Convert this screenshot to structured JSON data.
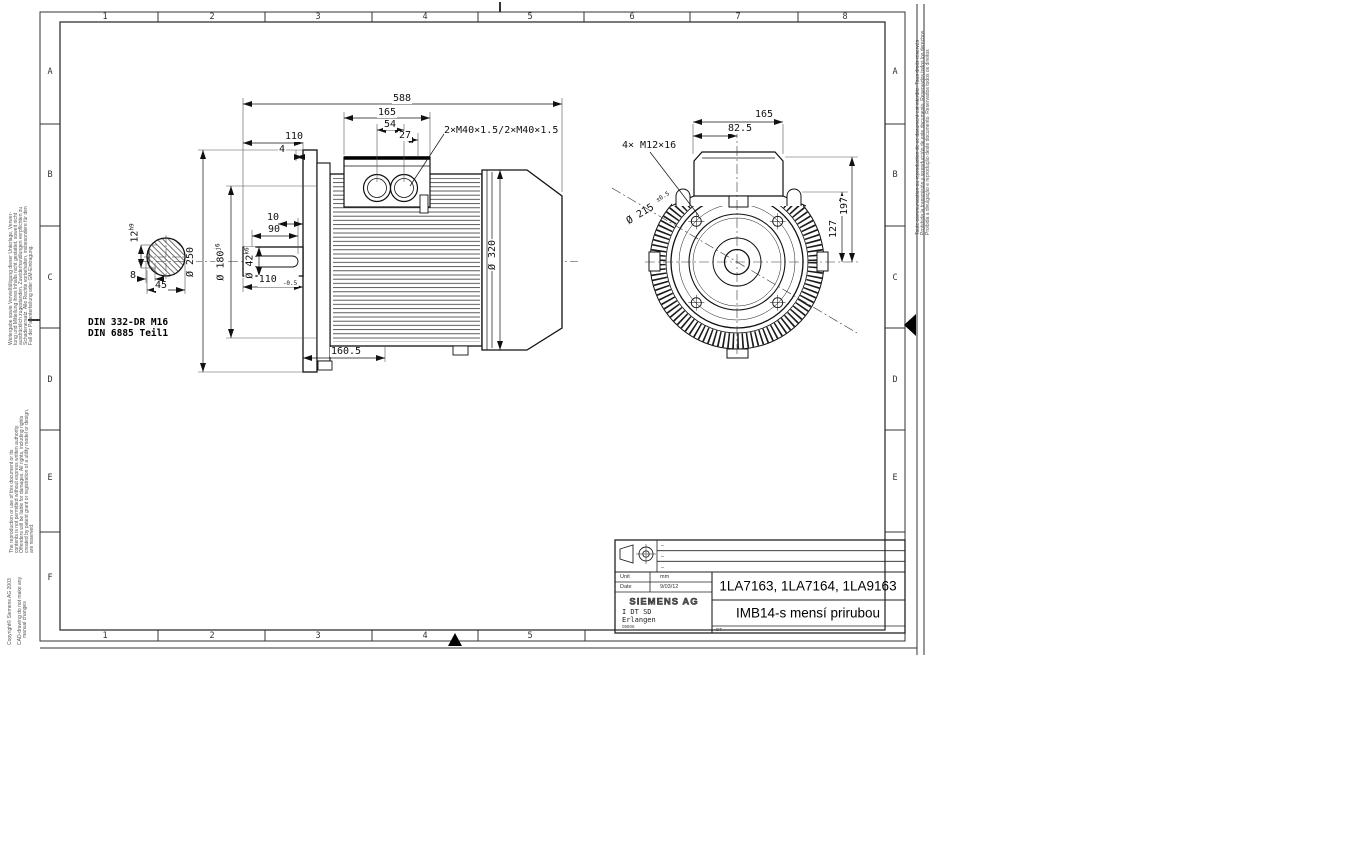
{
  "sheet": {
    "cols_top": [
      "1",
      "2",
      "3",
      "4",
      "5",
      "6",
      "7",
      "8"
    ],
    "cols_bottom": [
      "1",
      "2",
      "3",
      "4",
      "5"
    ],
    "rows_left": [
      "A",
      "B",
      "C",
      "D",
      "E",
      "F"
    ],
    "rows_right": [
      "A",
      "B",
      "C",
      "D",
      "E"
    ]
  },
  "margin_notes": {
    "de": [
      "Weitergabe sowie Vervielfältigung dieser Unterlage, Verwer-",
      "tung und Mitteilung ihres Inhalts nicht gestattet, soweit nicht",
      "ausdrücklich zugestanden. Zuwiderhandlungen verpflichten zu",
      "Schadenersatz. Alle Rechte vorbehalten, insbesondere für den",
      "Fall der Patenterteilung oder GM-Eintragung."
    ],
    "en": [
      "The reproduction or use of this document or its",
      "contents is not permitted without express written authority.",
      "Offenders will be liable for damages. All rights, including rights",
      "created by patent grant or registration of a utility model or design,",
      "are reserved."
    ],
    "copyright": "Copyright© Siemens AG 2003",
    "cad": [
      "CAD-drawing do not make any",
      "manual changes"
    ],
    "intl": [
      "Toute communication ou reproduction de ce document est interdite. Tous droits réservés",
      "Prohibida la transmisión y reproducción de este documento. Reservados todos los derechos",
      "Proibida a divulgação e reprodução deste documento. Reservados todos os direitos"
    ]
  },
  "side_view": {
    "overall_length": "588",
    "box_width": "165",
    "gland_spacing": "54",
    "gland_offset": "27",
    "shaft_clear": "110",
    "flange_gap": "4",
    "glands_label": "2×M40×1.5/2×M40×1.5",
    "key_end": "10",
    "key_length": "90",
    "shaft_length": "110",
    "shaft_length_tol": "-0.5",
    "flange_dia": "Ø 250",
    "spigot_dia": "Ø 180",
    "spigot_tol": "j6",
    "shaft_dia": "Ø 42",
    "shaft_tol": "k6",
    "cowl_dia": "Ø 320",
    "flange_to_frame": "160.5",
    "key_width": "12",
    "key_width_tol": "h9",
    "key_height": "8",
    "key_across": "45",
    "din_center": "DIN 332-DR M16",
    "din_key": "DIN 6885 Teil1"
  },
  "flange_view": {
    "box_width": "165",
    "box_half": "82.5",
    "holes": "4× M12×16",
    "bolt_circle": "Ø 215",
    "bolt_circle_tol": "±0.5",
    "box_height": "197",
    "flange_height": "127"
  },
  "title_block": {
    "unit_label": "Unit",
    "unit_value": "mm",
    "date_label": "Date",
    "date_value": "9/03/12",
    "company": "SIEMENS AG",
    "dept": "I DT SD",
    "city": "Erlangen",
    "doc_code": "05806",
    "types": "1LA7163, 1LA7164, 1LA9163",
    "title": "IMB14-s mensí prirubou",
    "corner_code": "DT",
    "rev": [
      "–",
      "–",
      "–"
    ]
  }
}
